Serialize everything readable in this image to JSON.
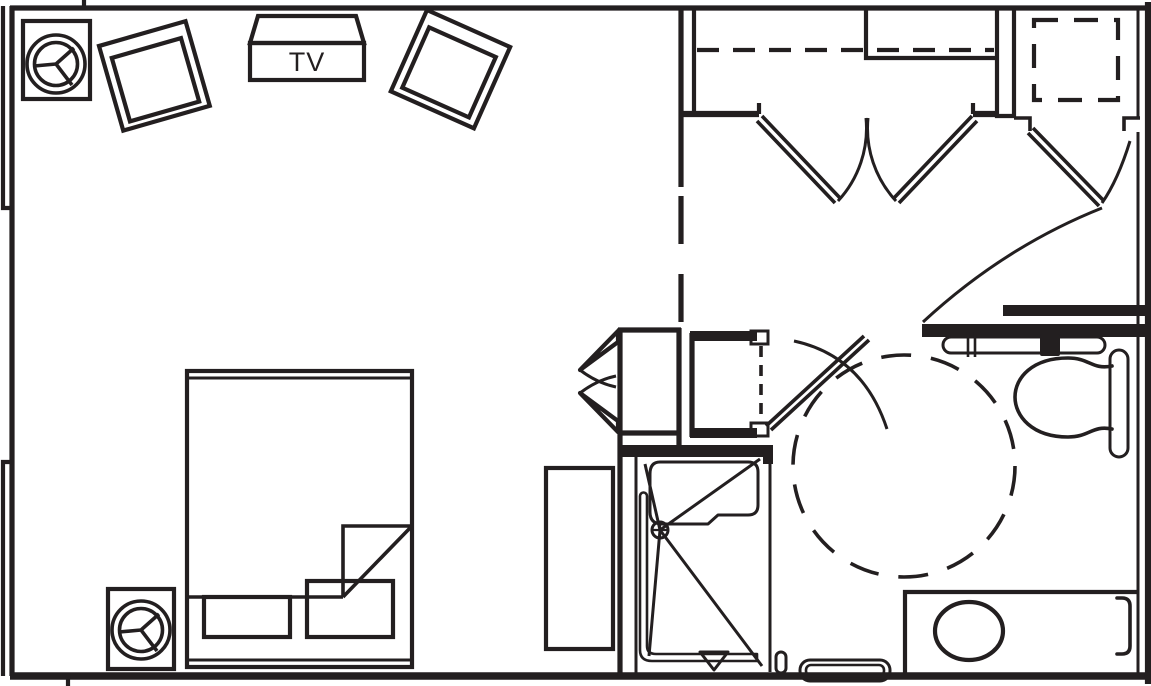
{
  "labels": {
    "tv": "TV"
  },
  "colors": {
    "ink": "#231f20",
    "paper": "#ffffff"
  },
  "drawing": {
    "type": "floor-plan",
    "rooms": [
      "guest-room",
      "entry-corridor",
      "bathroom",
      "closet",
      "entry-alcove"
    ],
    "symbols": [
      "lounge-chair",
      "lounge-chair",
      "tv-cabinet",
      "round-lamp-table",
      "round-lamp-table",
      "bed-with-pillows-and-folded-blanket",
      "dresser-bench",
      "closet-shelf-dashed",
      "double-closet-doors",
      "bifold-closet-doors",
      "entry-door-swing",
      "bathroom-door-swing",
      "roll-in-shower-with-seat",
      "shower-head",
      "floor-drain",
      "l-shaped-grab-bar",
      "rear-grab-bar",
      "wall-hung-toilet",
      "vanity-counter-with-sink",
      "towel-bar",
      "wheelchair-turning-circle-dashed",
      "clear-floor-space-dashed-square"
    ]
  }
}
